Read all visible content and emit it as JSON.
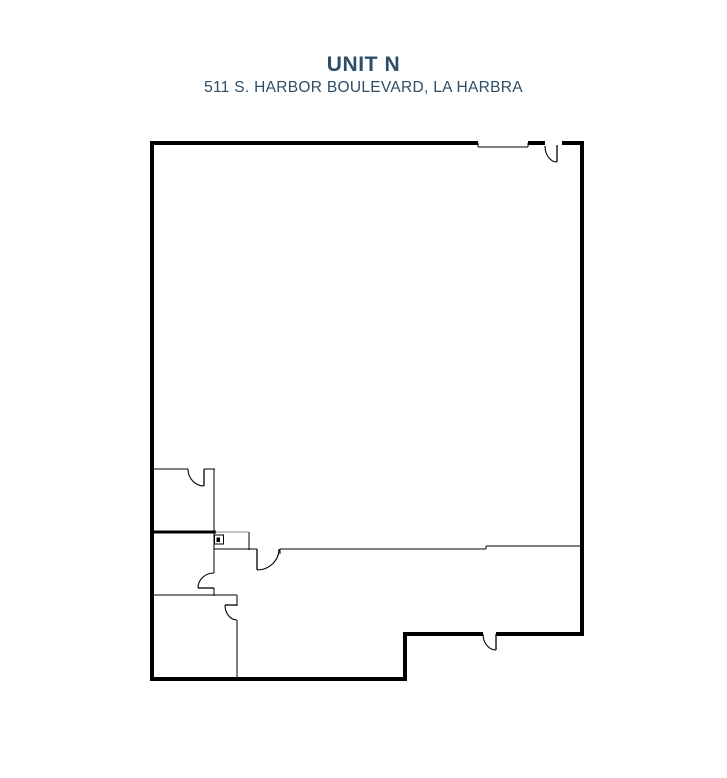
{
  "header": {
    "title": "UNIT N",
    "address": "511 S. HARBOR BOULEVARD, LA HARBRA"
  },
  "colors": {
    "title_text": "#2e4d66",
    "wall": "#000000",
    "light_line": "#8a8a8a",
    "background": "#ffffff"
  },
  "floorplan": {
    "canvas": {
      "width": 727,
      "height": 778
    },
    "exterior_walls": [
      {
        "x1": 152,
        "y1": 141,
        "x2": 152,
        "y2": 681
      },
      {
        "x1": 150,
        "y1": 143,
        "x2": 478,
        "y2": 143
      },
      {
        "x1": 528,
        "y1": 143,
        "x2": 545,
        "y2": 143
      },
      {
        "x1": 562,
        "y1": 143,
        "x2": 584,
        "y2": 143
      },
      {
        "x1": 582,
        "y1": 141,
        "x2": 582,
        "y2": 636
      },
      {
        "x1": 584,
        "y1": 634,
        "x2": 496,
        "y2": 634
      },
      {
        "x1": 483,
        "y1": 634,
        "x2": 403,
        "y2": 634
      },
      {
        "x1": 405,
        "y1": 632,
        "x2": 405,
        "y2": 681
      },
      {
        "x1": 407,
        "y1": 679,
        "x2": 150,
        "y2": 679
      }
    ],
    "interior_walls": [
      {
        "x1": 152,
        "y1": 469,
        "x2": 188,
        "y2": 469
      },
      {
        "x1": 204,
        "y1": 469,
        "x2": 215,
        "y2": 469
      },
      {
        "x1": 214,
        "y1": 469,
        "x2": 214,
        "y2": 573
      },
      {
        "x1": 214,
        "y1": 588,
        "x2": 214,
        "y2": 596
      },
      {
        "x1": 152,
        "y1": 595,
        "x2": 237,
        "y2": 595
      },
      {
        "x1": 237,
        "y1": 595,
        "x2": 237,
        "y2": 606
      },
      {
        "x1": 237,
        "y1": 620,
        "x2": 237,
        "y2": 681
      },
      {
        "x1": 214,
        "y1": 549,
        "x2": 257,
        "y2": 549
      },
      {
        "x1": 280,
        "y1": 549,
        "x2": 280,
        "y2": 554
      },
      {
        "x1": 280,
        "y1": 549,
        "x2": 486,
        "y2": 549
      },
      {
        "x1": 486,
        "y1": 549,
        "x2": 486,
        "y2": 546
      },
      {
        "x1": 486,
        "y1": 546,
        "x2": 584,
        "y2": 546
      },
      {
        "x1": 249,
        "y1": 532,
        "x2": 249,
        "y2": 550
      }
    ],
    "thick_interior_walls": [
      {
        "x1": 152,
        "y1": 532,
        "x2": 216,
        "y2": 532
      }
    ],
    "light_lines": [
      {
        "x1": 215,
        "y1": 532,
        "x2": 249,
        "y2": 532
      }
    ],
    "door_leaves": [
      {
        "x1": 557,
        "y1": 145,
        "x2": 557,
        "y2": 162
      },
      {
        "x1": 204,
        "y1": 469,
        "x2": 204,
        "y2": 486
      },
      {
        "x1": 198,
        "y1": 588,
        "x2": 214,
        "y2": 588
      },
      {
        "x1": 225,
        "y1": 605,
        "x2": 237,
        "y2": 605
      },
      {
        "x1": 257,
        "y1": 549,
        "x2": 257,
        "y2": 570
      },
      {
        "x1": 496,
        "y1": 634,
        "x2": 496,
        "y2": 650
      }
    ],
    "door_arcs": [
      {
        "d": "M545,146 A12,16 0 0 0 557,162"
      },
      {
        "d": "M188,469 A16,17 0 0 0 204,486"
      },
      {
        "d": "M198,588 A16,15 0 0 1 214,573"
      },
      {
        "d": "M225,605 A12,15 0 0 0 237,620"
      },
      {
        "d": "M257,570 A22,21 0 0 0 279,549"
      },
      {
        "d": "M483,634 A13,16 0 0 0 496,650"
      }
    ],
    "window": {
      "line": {
        "x1": 478,
        "y1": 147,
        "x2": 528,
        "y2": 147
      },
      "ticks": [
        {
          "x1": 478,
          "y1": 143,
          "x2": 478,
          "y2": 147
        },
        {
          "x1": 528,
          "y1": 143,
          "x2": 528,
          "y2": 147
        }
      ]
    },
    "panel": {
      "box": {
        "x": 214.5,
        "y": 535,
        "w": 9,
        "h": 9
      },
      "dot": {
        "x": 216.5,
        "y": 537.5,
        "w": 3.5,
        "h": 4.5
      }
    }
  }
}
